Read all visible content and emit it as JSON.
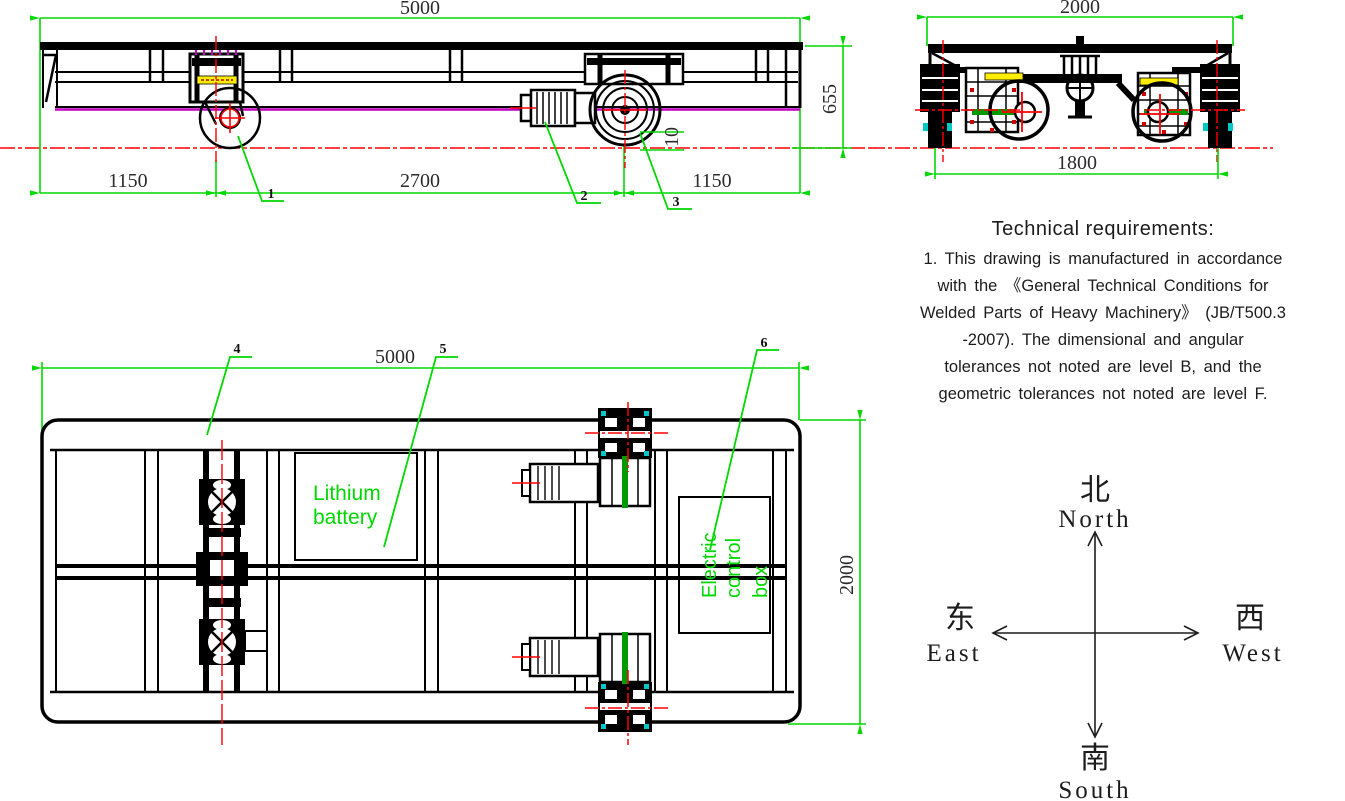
{
  "side_view": {
    "dims": {
      "overall_length": "5000",
      "left_span": "1150",
      "center_span": "2700",
      "right_span": "1150",
      "height": "655",
      "wheel_rail_gap": "10"
    },
    "callouts": [
      "1",
      "2",
      "3"
    ]
  },
  "end_view": {
    "dims": {
      "overall_width": "2000",
      "track_gauge": "1800"
    }
  },
  "plan_view": {
    "dims": {
      "overall_length": "5000",
      "overall_width": "2000"
    },
    "callouts": [
      "4",
      "5",
      "6"
    ],
    "battery_label": [
      "Lithium",
      "battery"
    ],
    "control_box_label": [
      "Electric",
      "control",
      "box"
    ]
  },
  "tech": {
    "title": "Technical requirements:",
    "lines": [
      "1. This drawing is manufactured in accordance",
      "with the 《General Technical Conditions for",
      "Welded Parts of Heavy Machinery》 (JB/T500.3",
      "-2007). The dimensional and angular",
      "tolerances not noted are level B, and the",
      "geometric tolerances not noted are level F."
    ]
  },
  "compass": {
    "north_cn": "北",
    "north_en": "North",
    "south_cn": "南",
    "south_en": "South",
    "east_cn": "东",
    "east_en": "East",
    "west_cn": "西",
    "west_en": "West"
  },
  "colors": {
    "dimension_green": "#00d800",
    "centerline_red": "#ff0000",
    "deck_edge_purple": "#c000c0",
    "motor_label_yellow": "#ffee00",
    "shaft_green": "#009900",
    "drawing_black": "#000000"
  }
}
